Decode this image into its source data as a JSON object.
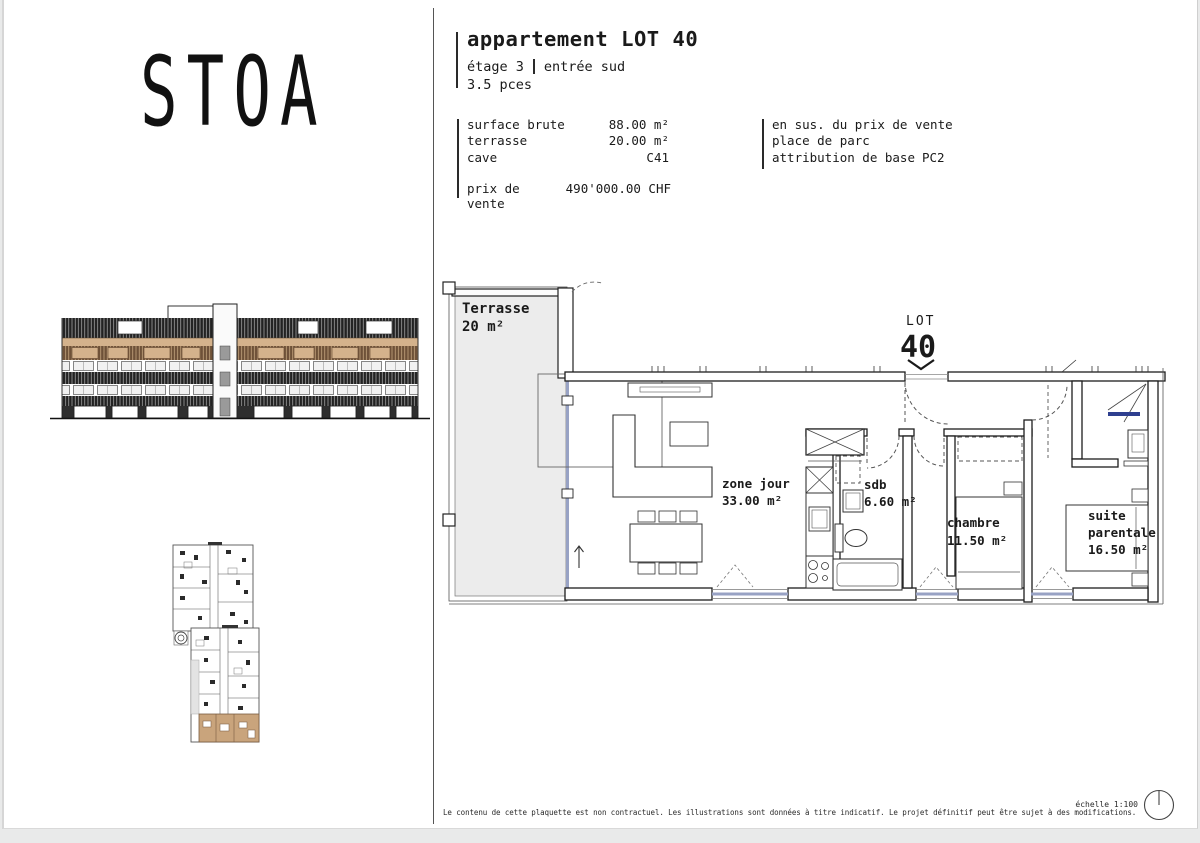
{
  "brand": {
    "logo": "STOA"
  },
  "header": {
    "title": "appartement LOT 40",
    "floor": "étage 3",
    "entrance": "entrée sud",
    "pieces": "3.5 pces",
    "details": [
      {
        "label": "surface brute",
        "value": "88.00 m²"
      },
      {
        "label": "terrasse",
        "value": "20.00 m²"
      },
      {
        "label": "cave",
        "value": "C41"
      }
    ],
    "price": {
      "label": "prix de vente",
      "value": "490'000.00 CHF"
    },
    "extras": {
      "title": "en sus. du prix de vente",
      "item": "place de parc",
      "attribution_label": "attribution de base",
      "attribution_value": "PC2"
    }
  },
  "plan": {
    "lot_caption": "LOT",
    "lot_number": "40",
    "terrasse_name": "Terrasse",
    "terrasse_area": "20 m²",
    "zone_jour_name": "zone jour",
    "zone_jour_area": "33.00 m²",
    "sdb_name": "sdb",
    "sdb_area": "6.60 m²",
    "chambre_name": "chambre",
    "chambre_area": "11.50 m²",
    "suite_name_line1": "suite",
    "suite_name_line2": "parentale",
    "suite_area": "16.50 m²"
  },
  "footer": {
    "disclaimer": "Le contenu de cette plaquette est non contractuel. Les illustrations sont données à titre indicatif. Le projet définitif peut être sujet à des modifications.",
    "scale": "échelle 1:100"
  },
  "colors": {
    "accent_tan": "#c8a379",
    "window_blue": "#98a2c4",
    "shower_glass": "#2e3f8f",
    "terrace_fill": "#ececec"
  }
}
